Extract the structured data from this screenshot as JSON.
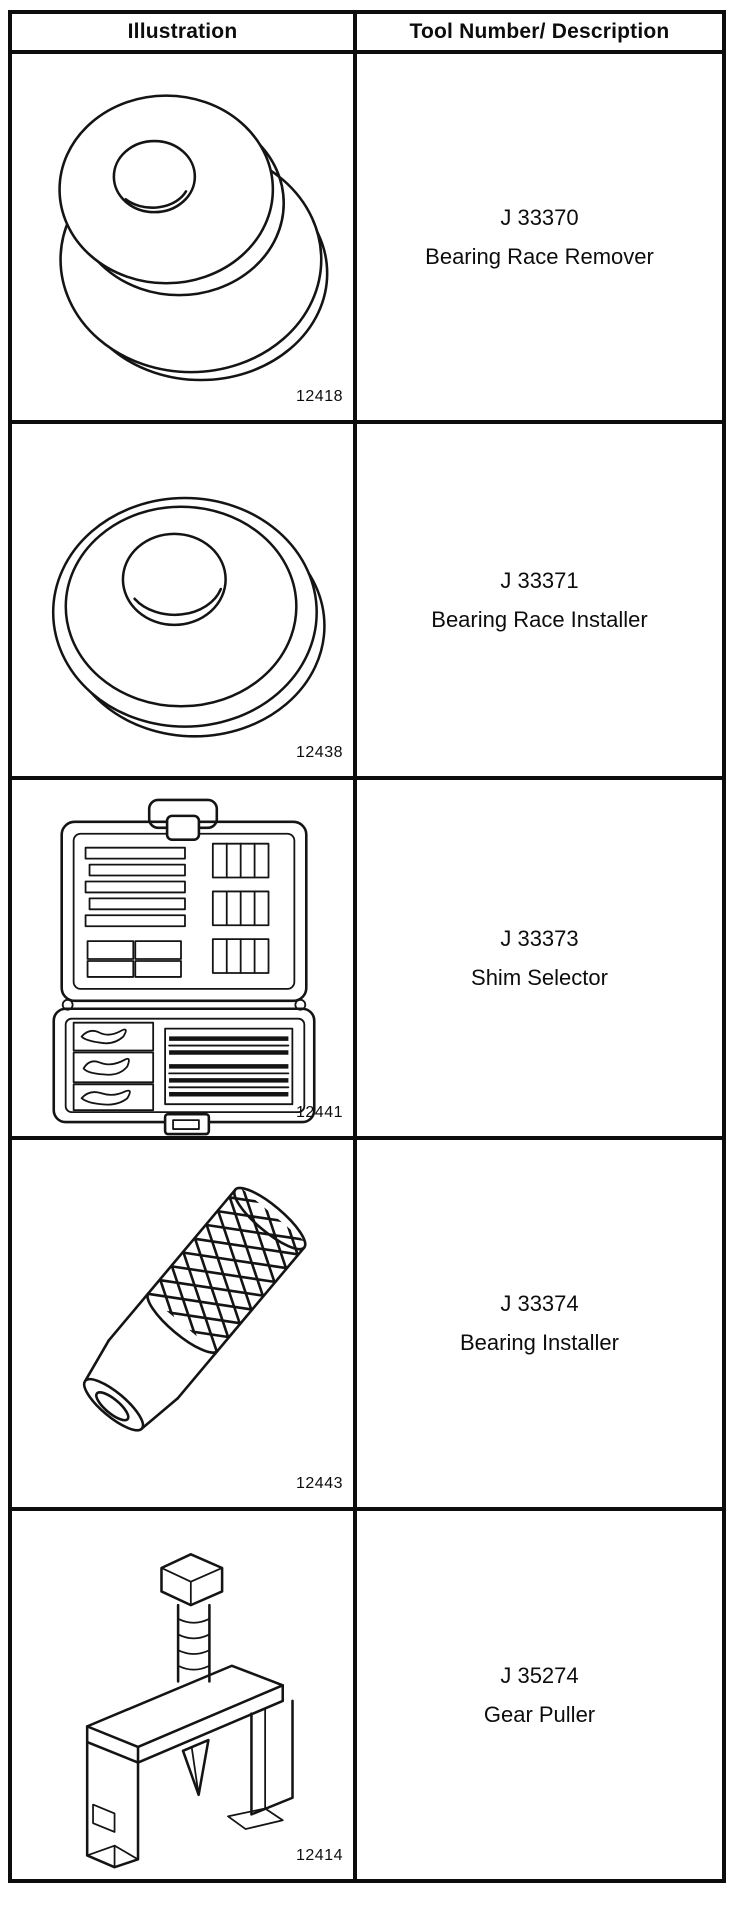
{
  "table": {
    "headers": {
      "illustration": "Illustration",
      "tool": "Tool Number/ Description"
    },
    "rows": [
      {
        "tool_number": "J 33370",
        "description": "Bearing Race Remover",
        "figure_number": "12418",
        "illustration": "bearing-race-remover"
      },
      {
        "tool_number": "J 33371",
        "description": "Bearing Race Installer",
        "figure_number": "12438",
        "illustration": "bearing-race-installer"
      },
      {
        "tool_number": "J 33373",
        "description": "Shim Selector",
        "figure_number": "12441",
        "illustration": "shim-selector-case"
      },
      {
        "tool_number": "J 33374",
        "description": "Bearing Installer",
        "figure_number": "12443",
        "illustration": "knurled-bearing-installer"
      },
      {
        "tool_number": "J 35274",
        "description": "Gear Puller",
        "figure_number": "12414",
        "illustration": "gear-puller"
      }
    ]
  },
  "colors": {
    "ink": "#141414",
    "paper": "#ffffff"
  }
}
